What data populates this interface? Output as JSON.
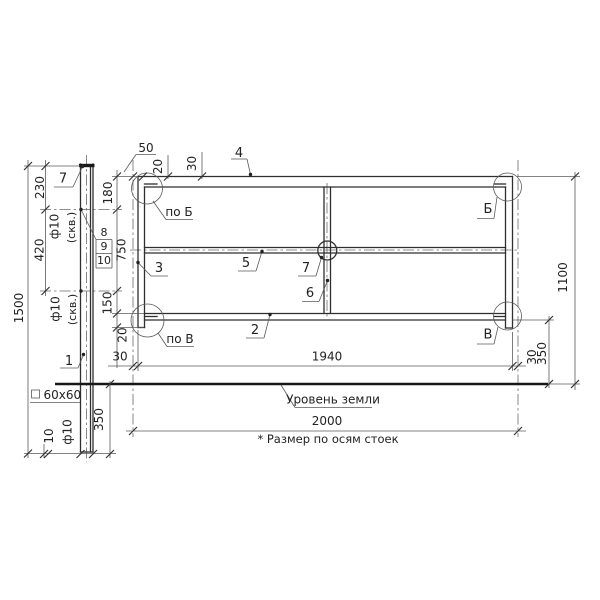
{
  "drawing": {
    "dims": {
      "h1500": "1500",
      "v230": "230",
      "v420": "420",
      "v180": "180",
      "v750": "750",
      "v150": "150",
      "v20": "20",
      "t50": "50",
      "t20": "20",
      "t30": "30",
      "b30l": "30",
      "b1940": "1940",
      "b30r": "30",
      "b2000": "2000",
      "r350": "350",
      "r1100": "1100",
      "g350": "350",
      "g10": "10"
    },
    "holes": {
      "top_d": "ф10",
      "top_note": "(скв.)",
      "bot_d": "ф10",
      "bot_note": "(скв.)",
      "drain_d": "ф10"
    },
    "profile": {
      "square_label": "60x60"
    },
    "parts": {
      "p1": "1",
      "p2": "2",
      "p3": "3",
      "p4": "4",
      "p5": "5",
      "p6": "6",
      "p7": "7",
      "p8": "8",
      "p9": "9",
      "p10": "10"
    },
    "views": {
      "po_b": "по Б",
      "po_v": "по В",
      "b": "Б",
      "v": "В"
    },
    "notes": {
      "ground_level": "Уровень земли",
      "axes_note": "* Размер по осям стоек"
    }
  }
}
